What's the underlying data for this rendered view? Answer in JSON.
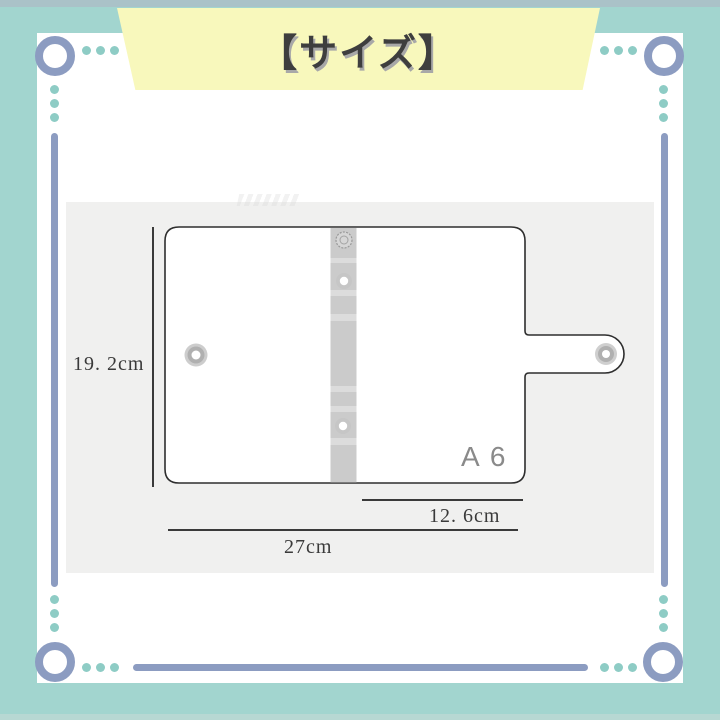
{
  "banner": {
    "title": "【サイズ】"
  },
  "product_diagram": {
    "size_label": "A 6",
    "height_label": "19. 2cm",
    "width_label": "27cm",
    "flap_width_label": "12. 6cm"
  },
  "colors": {
    "background_teal": "#a2d5cf",
    "frame_slate": "#8c9cc1",
    "dot_teal": "#8eccc5",
    "ribbon_yellow": "#f8f8bc",
    "title_text": "#3e3e3e",
    "panel_gray": "#f0f0ef",
    "outline": "#2e2e2e",
    "dimension_text": "#3a3a3a",
    "size_text": "#8a8a8a"
  }
}
